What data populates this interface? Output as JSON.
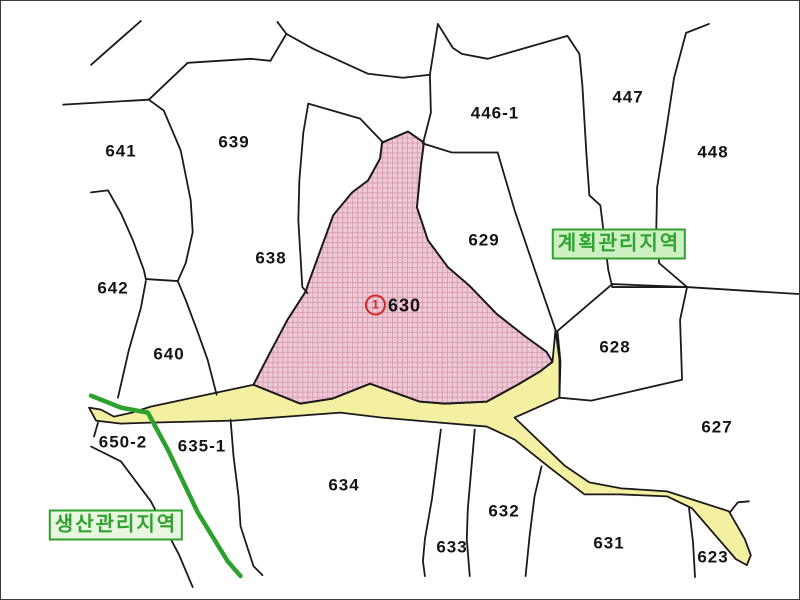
{
  "map": {
    "title": "cadastral-parcel-map",
    "parcels": {
      "p641": "641",
      "p639": "639",
      "p638": "638",
      "p642": "642",
      "p640": "640",
      "p446_1": "446-1",
      "p447": "447",
      "p448": "448",
      "p629": "629",
      "p628": "628",
      "p627": "627",
      "p650_2": "650-2",
      "p635_1": "635-1",
      "p634": "634",
      "p633": "633",
      "p632": "632",
      "p631": "631",
      "p623": "623"
    },
    "highlight": {
      "circle_number": "1",
      "parcel_number": "630"
    },
    "zones": {
      "planned": "계획관리지역",
      "production": "생산관리지역"
    },
    "colors": {
      "highlight_fill": "#F0CAD6",
      "highlight_hatch": "#D193A9",
      "road_fill": "#F4F0A2",
      "boundary_line": "#1A1A1A",
      "zone_green": "#2FA32F",
      "marker_red": "#D22828"
    }
  }
}
